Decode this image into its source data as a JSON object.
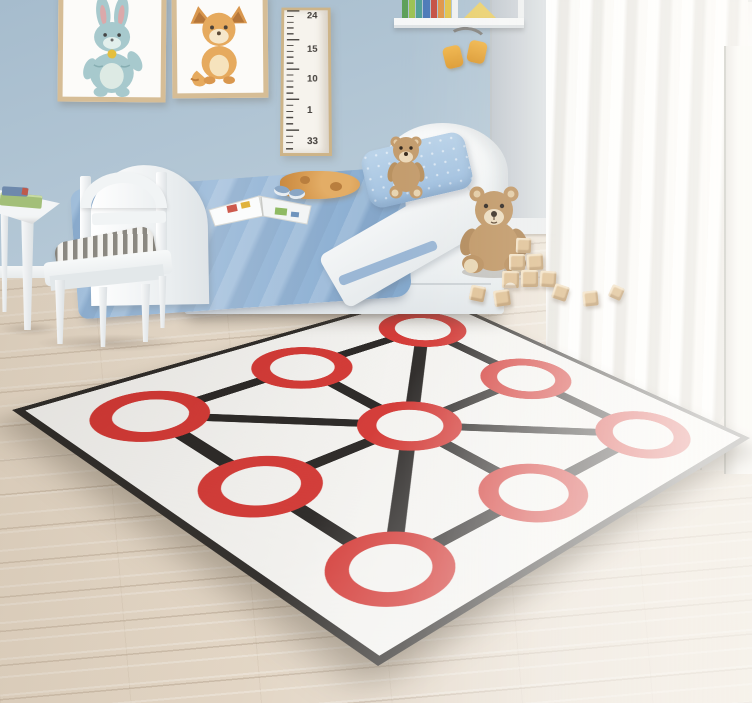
{
  "scene": {
    "type": "3d-rendered interior photo",
    "setting": "children's bedroom with a tic-tac-toe style game play mat on a wooden floor",
    "objects": [
      "two framed animal prints",
      "growth chart ruler",
      "wall shelf with books",
      "hanging yellow headphones",
      "white toddler bed with blue bedding",
      "small teddy bear on pillow",
      "open picture book",
      "orange plush toy",
      "white kids chair with striped cushion",
      "white kids table with books",
      "large teddy bear on floor",
      "wooden toy blocks",
      "sheer white curtains",
      "white play mat with nine red circles connected by black lines"
    ],
    "colors": {
      "wall_blue": "#b4c7d5",
      "floor_wood": "#e6dbcb",
      "curtain_white": "#f6f4f1",
      "bed_white": "#f3f5f6",
      "blanket_blue": "#96b6d5",
      "pillow_blue": "#aecbe6",
      "teddy_brown": "#c09766",
      "blocks_wood": "#e0c297",
      "frame_wood": "#d6bd96",
      "headphones_yellow": "#e7a83e"
    }
  },
  "growth_ruler": {
    "labels": [
      "24",
      "15",
      "10",
      "1",
      "33"
    ]
  },
  "play_mat": {
    "bg_color": "#f3f2ef",
    "ring_color": "#d23430",
    "line_color": "#252220",
    "edge_color": "#2a2724",
    "grid": "3x3",
    "node_count": 9,
    "line_count": 8
  }
}
